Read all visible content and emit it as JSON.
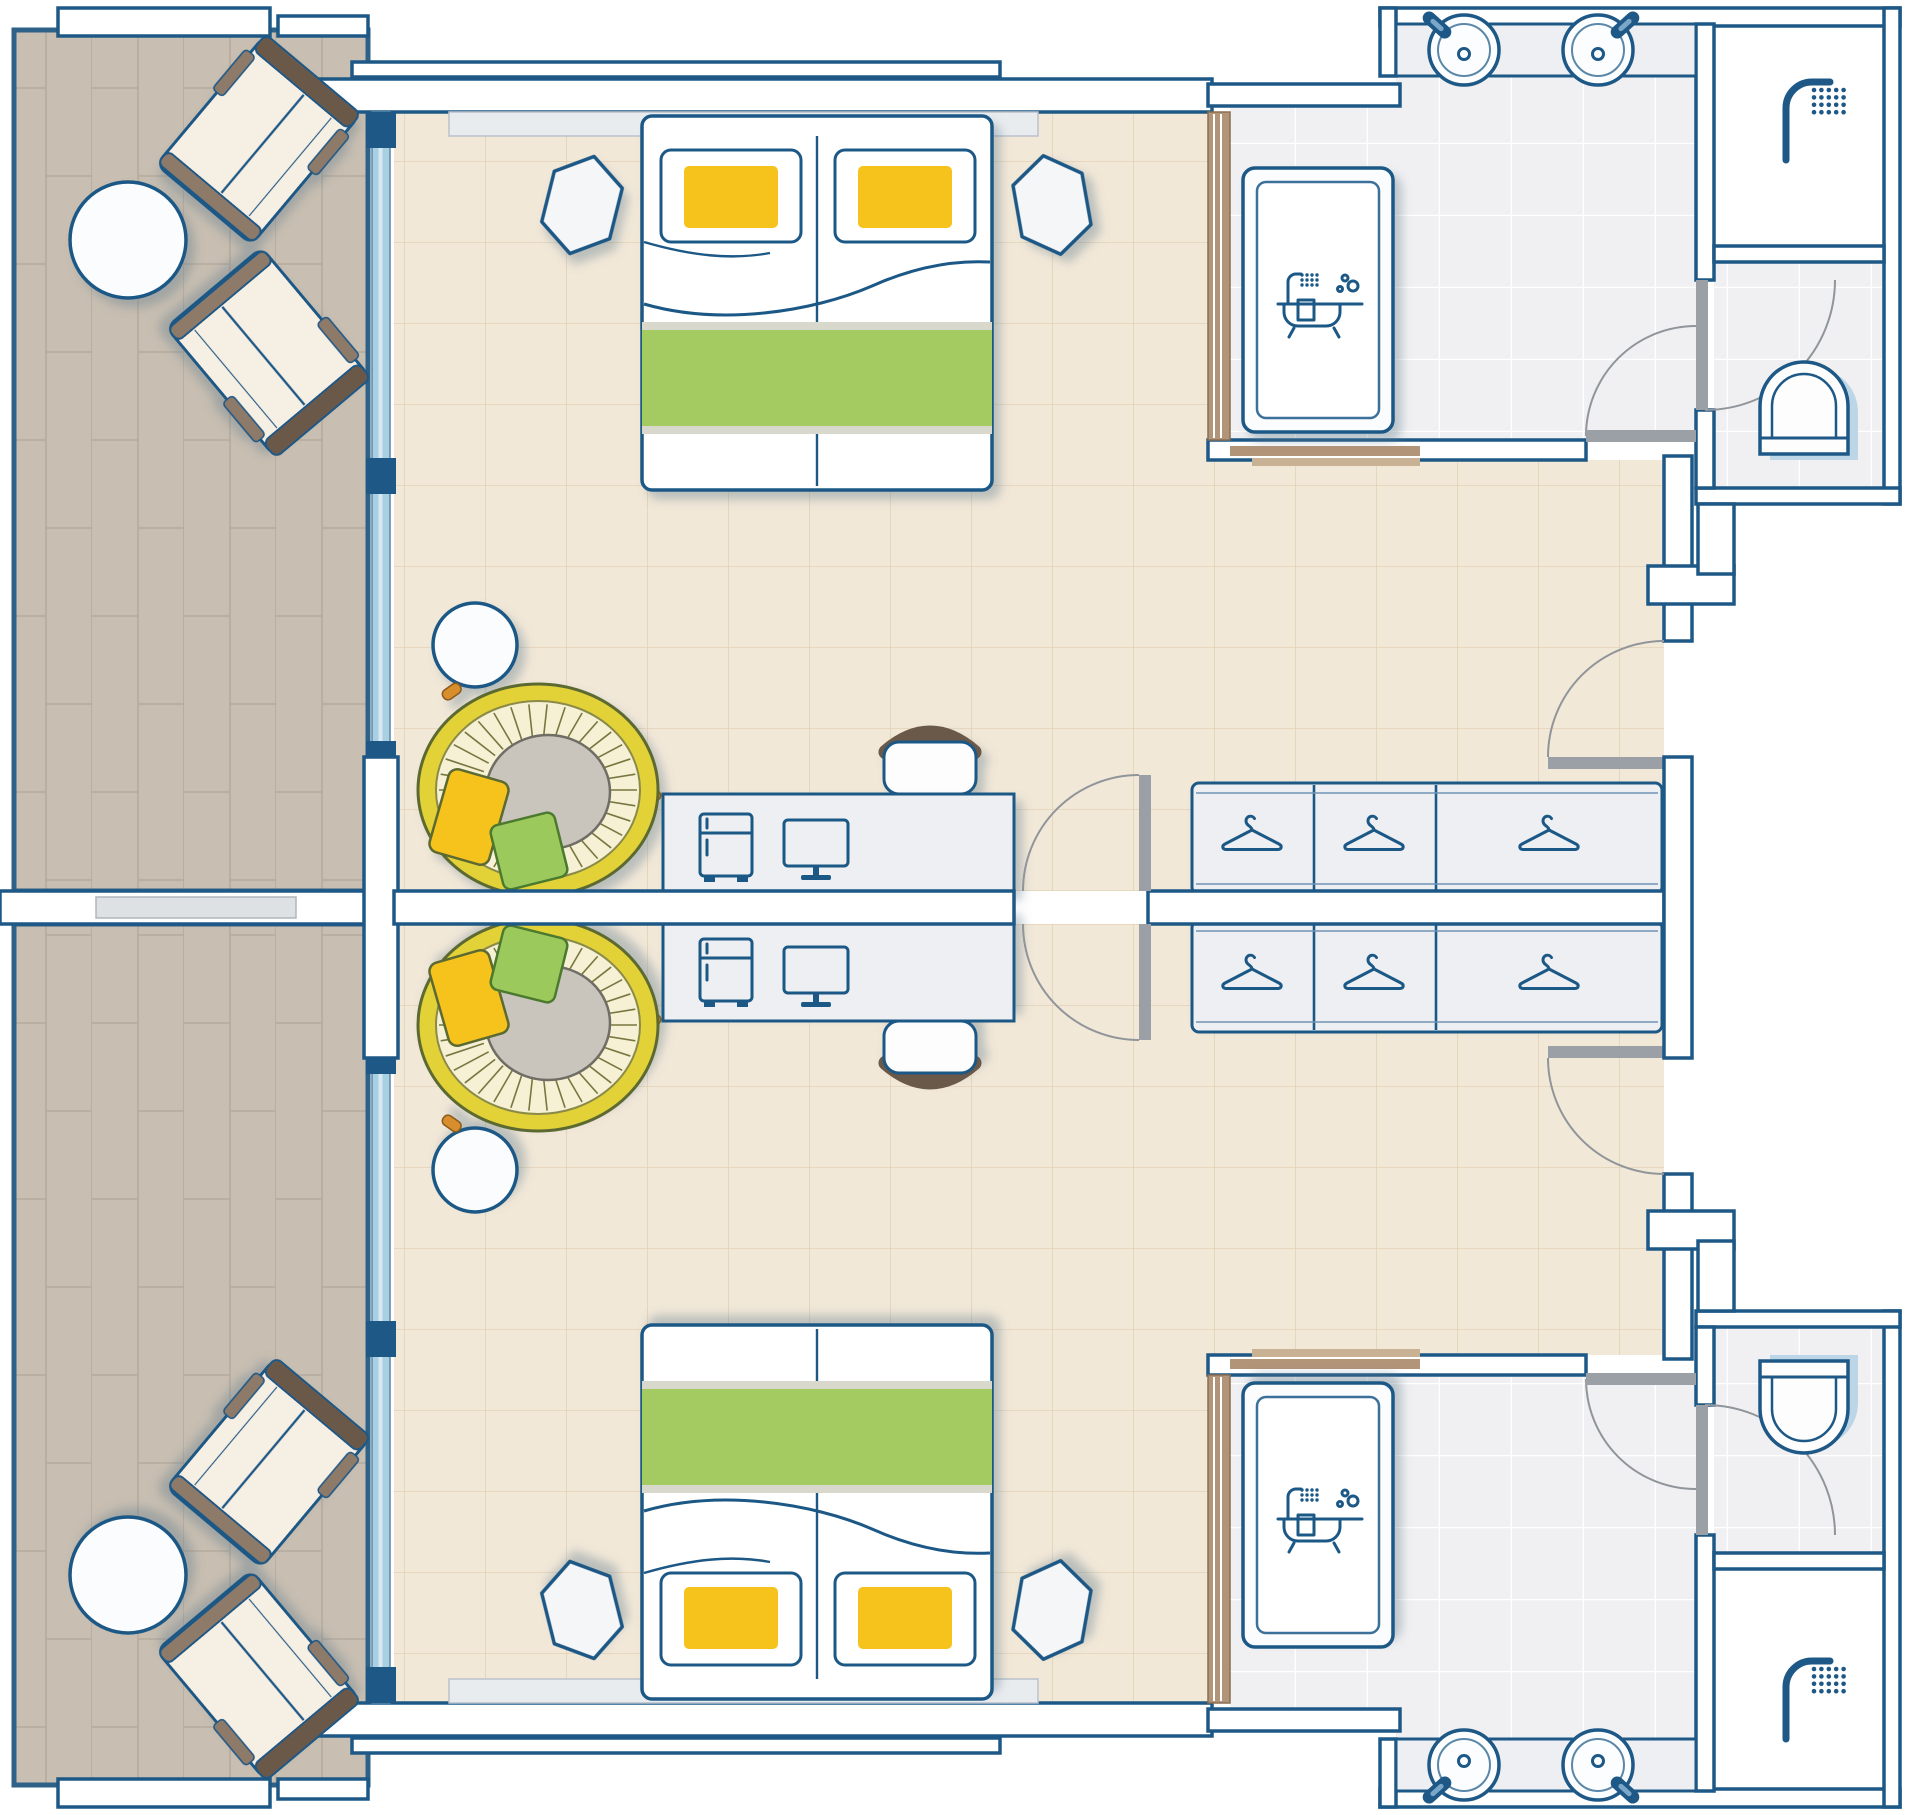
{
  "document": {
    "type": "floor-plan",
    "title": "Hotel connecting guest rooms - top-view floor plan",
    "canvas": {
      "width": 1920,
      "height": 1815
    }
  },
  "palette": {
    "outline": "#1d5886",
    "wall_fill": "#ffffff",
    "balcony_floor": "#c8beb1",
    "bedroom_floor": "#f2e8d8",
    "bath_floor": "#f0f0f2",
    "furniture_gray": "#edeff2",
    "glass_blue": "#a9cfe2",
    "accent_green": "#a4ca62",
    "accent_yellow": "#f5c31e",
    "pillow_green": "#9cc95c",
    "papasan_ring": "#e3d139",
    "papasan_weave": "#f6f0d4",
    "cushion_gray": "#c9c5bd",
    "wood_dark": "#6a584a",
    "wood_mid": "#8d7a69",
    "partition_wood": "#b29478",
    "partition_wood_light": "#c9b193",
    "door_leaf": "#9aa0a5",
    "swing_arc": "#90959a",
    "headboard": "#e9ecef",
    "runner_edge": "#d8d8cc",
    "toilet_shadow": "#bcd6e8",
    "divider_insert": "#dde1e4"
  },
  "rooms": [
    {
      "id": "balcony-a",
      "name": "balcony (room A)",
      "floor": "wood-plank",
      "furniture": [
        "lounge-chair",
        "lounge-chair",
        "round-table"
      ]
    },
    {
      "id": "guest-room-a",
      "name": "guest room A",
      "floor": "ceramic-tile",
      "furniture": [
        "double-bed",
        "pillow",
        "pillow",
        "bed-runner",
        "nightstand",
        "nightstand",
        "papasan-chair",
        "side-table",
        "work-desk",
        "mini-fridge",
        "monitor",
        "desk-chair",
        "wardrobe-with-3-hanger-sections"
      ]
    },
    {
      "id": "bathroom-a",
      "name": "bathroom A",
      "floor": "white-tile",
      "furniture": [
        "bathtub",
        "vanity-with-two-sinks",
        "wood-partition"
      ]
    },
    {
      "id": "shower-room-a",
      "name": "shower room A",
      "furniture": [
        "walk-in-shower"
      ]
    },
    {
      "id": "wc-a",
      "name": "WC A",
      "furniture": [
        "toilet"
      ]
    },
    {
      "id": "balcony-b",
      "name": "balcony (room B)",
      "floor": "wood-plank",
      "furniture": [
        "lounge-chair",
        "lounge-chair",
        "round-table"
      ]
    },
    {
      "id": "guest-room-b",
      "name": "guest room B",
      "floor": "ceramic-tile",
      "furniture": [
        "double-bed",
        "pillow",
        "pillow",
        "bed-runner",
        "nightstand",
        "nightstand",
        "papasan-chair",
        "side-table",
        "work-desk",
        "mini-fridge",
        "monitor",
        "desk-chair",
        "wardrobe-with-3-hanger-sections"
      ]
    },
    {
      "id": "bathroom-b",
      "name": "bathroom B",
      "floor": "white-tile",
      "furniture": [
        "bathtub",
        "vanity-with-two-sinks",
        "wood-partition"
      ]
    },
    {
      "id": "shower-room-b",
      "name": "shower room B",
      "furniture": [
        "walk-in-shower"
      ]
    },
    {
      "id": "wc-b",
      "name": "WC B",
      "furniture": [
        "toilet"
      ]
    }
  ],
  "doors": [
    "entry-door-a",
    "entry-door-b",
    "connecting-door-pair",
    "bathroom-door-a",
    "bathroom-door-b",
    "wc-door-a",
    "wc-door-b"
  ],
  "windows": [
    "balcony-window-wall-a",
    "balcony-window-wall-b"
  ],
  "icons": [
    "hanger-icon",
    "fridge-icon",
    "monitor-icon",
    "bathtub-icon",
    "shower-icon",
    "faucet-icon",
    "sink-icon",
    "toilet-icon"
  ]
}
